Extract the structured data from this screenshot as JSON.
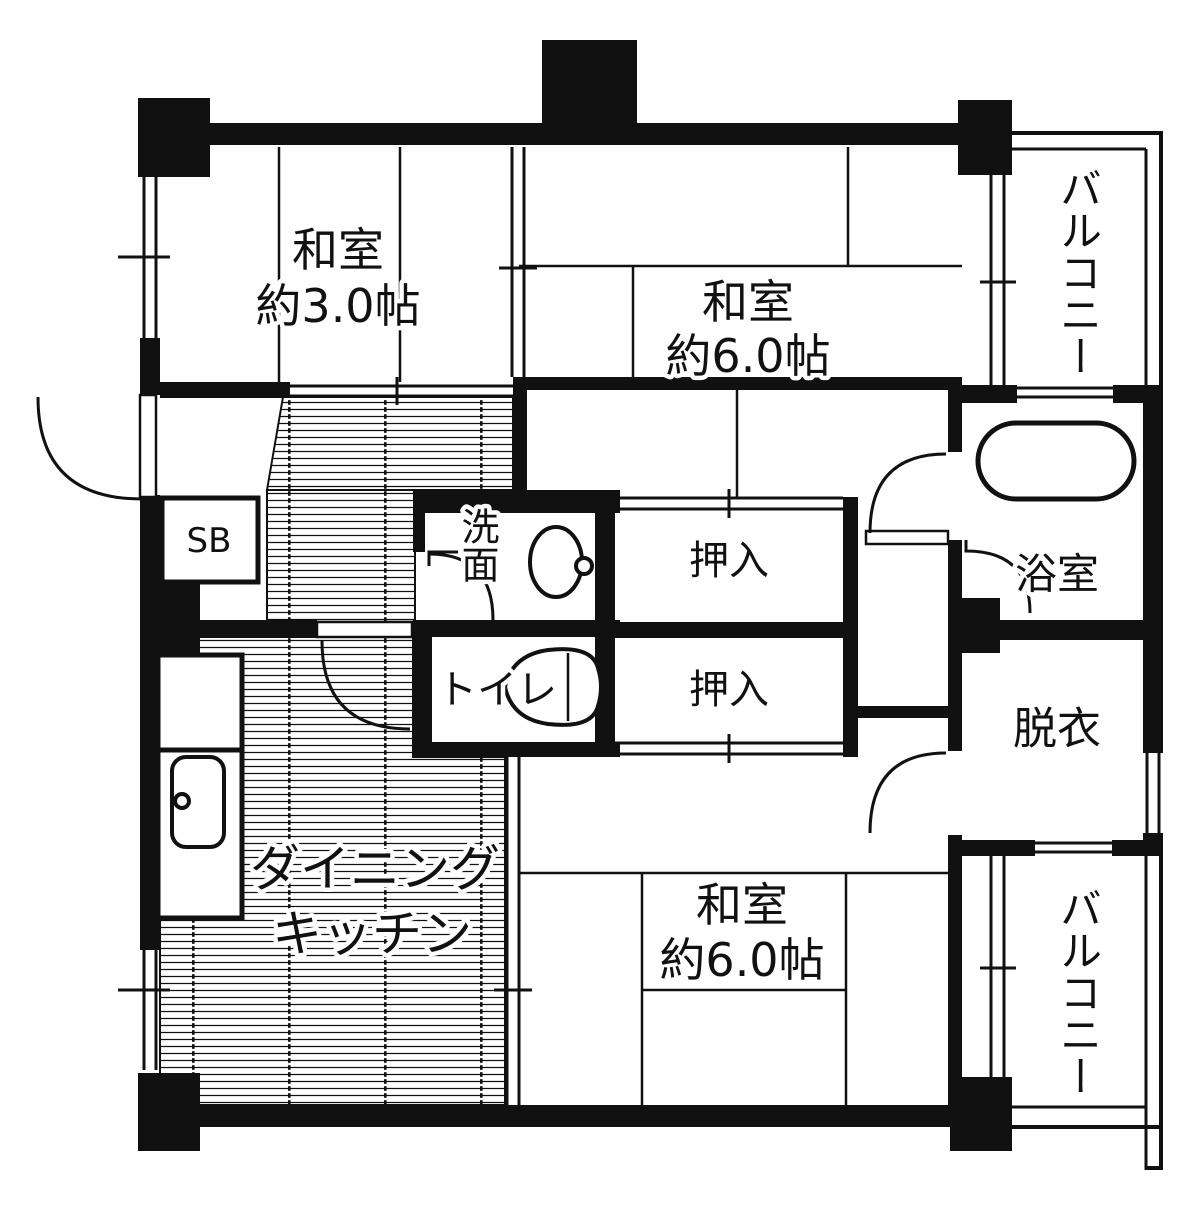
{
  "plan": {
    "type": "apartment-floor-plan",
    "colors": {
      "wall": "#111111",
      "background": "#ffffff",
      "hatch_line": "#111111"
    },
    "labels": {
      "washitsu3_line1": "和室",
      "washitsu3_line2": "約3.0帖",
      "washitsu6_top_line1": "和室",
      "washitsu6_top_line2": "約6.0帖",
      "washitsu6_bottom_line1": "和室",
      "washitsu6_bottom_line2": "約6.0帖",
      "dining_line1": "ダイニング",
      "dining_line2": "キッチン",
      "closet_top": "押入",
      "closet_bottom": "押入",
      "shoe_box": "SB",
      "washroom": "洗面",
      "toilet": "トイレ",
      "bathroom": "浴室",
      "dressing": "脱衣",
      "balcony_top": "バルコニー",
      "balcony_bottom": "バルコニー"
    },
    "fixtures": [
      "bathtub",
      "washbasin",
      "toilet",
      "kitchen-sink",
      "entrance-door",
      "room-doors",
      "windows",
      "sliding-doors"
    ]
  }
}
